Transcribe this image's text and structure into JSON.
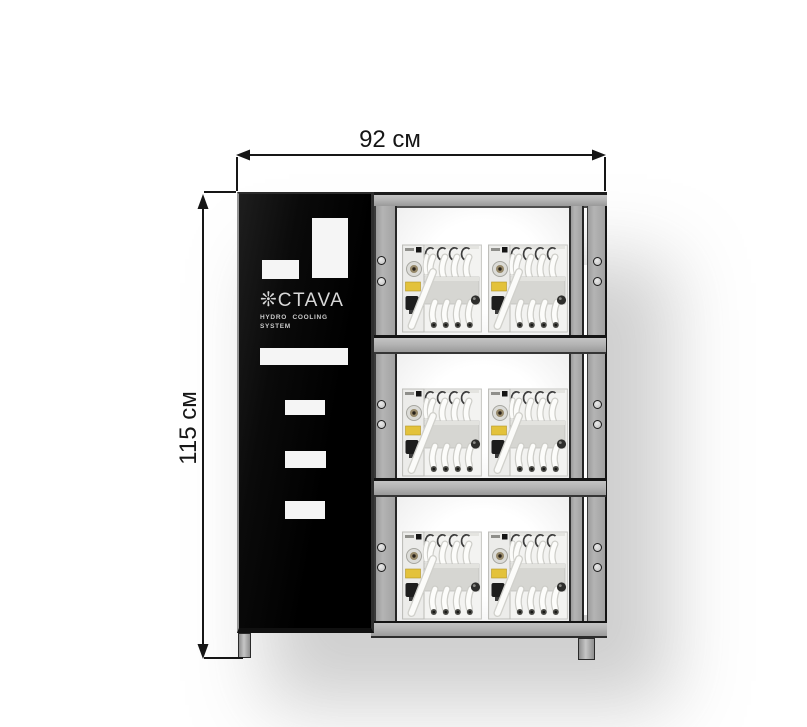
{
  "diagram": {
    "width_dimension": "92 см",
    "height_dimension": "115 см"
  },
  "cabinet": {
    "logo": {
      "icon_glyph": "❊",
      "text": "CTAVA",
      "tagline": [
        "HYDRO COOLING",
        "SYSTEM"
      ]
    },
    "shelves": 3,
    "units_per_shelf": 2
  },
  "colors": {
    "door": "#060606",
    "frame": "#b4b4b4",
    "frame_edge": "#1c1c1c",
    "vent": "#f5f5f5",
    "logo_text": "#d8d8d8",
    "dimension": "#161616",
    "label_yellow": "#e3c23b"
  }
}
